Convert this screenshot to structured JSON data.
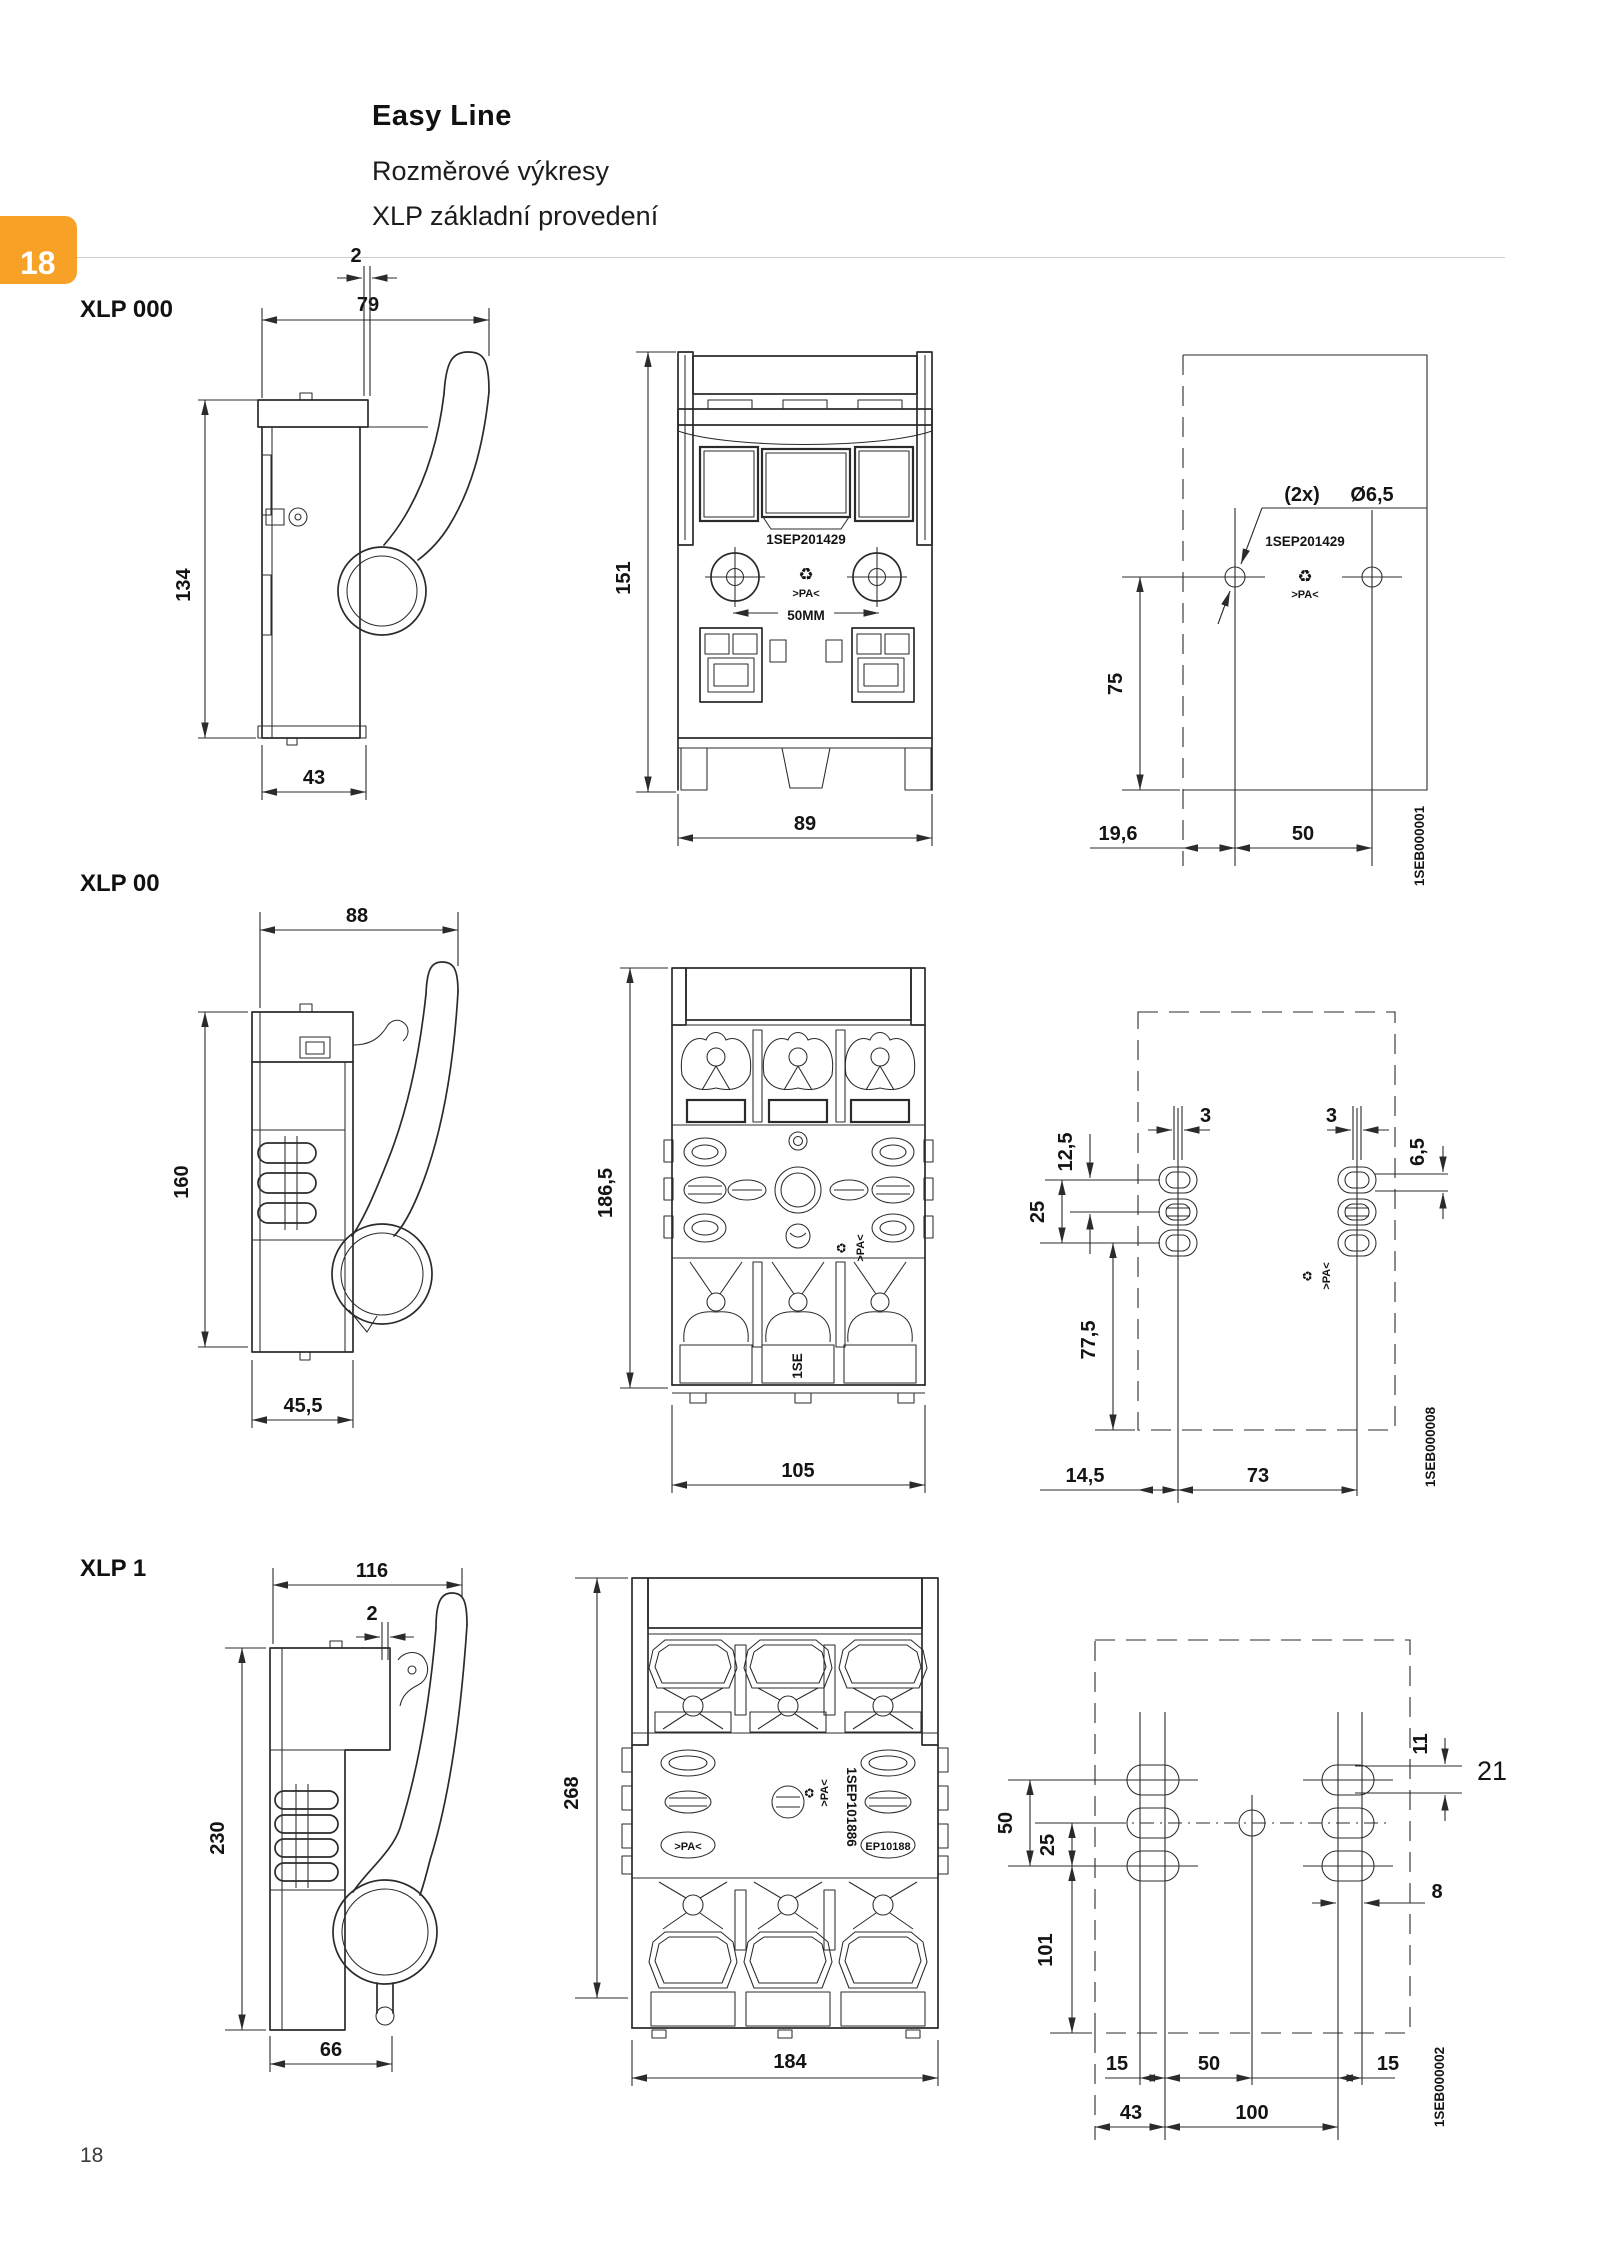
{
  "page": {
    "tab_number": "18",
    "page_number": "18",
    "accent_color": "#F7A127"
  },
  "header": {
    "title": "Easy Line",
    "subtitle_line1": "Rozměrové výkresy",
    "subtitle_line2": "XLP základní provedení"
  },
  "icons": {
    "recycling": "♻"
  },
  "sections": [
    {
      "name": "XLP 000",
      "side_view": {
        "dim_width": "79",
        "dim_gap": "2",
        "dim_height": "134",
        "dim_depth": "43"
      },
      "front_view": {
        "dim_height": "151",
        "dim_width": "89",
        "part_number": "1SEP201429",
        "material_marking": ">PA<",
        "fuse_label": "50MM"
      },
      "drill_plan": {
        "hole_count": "(2x)",
        "hole_diameter": "Ø6,5",
        "part_number": "1SEP201429",
        "material_marking": ">PA<",
        "dim_vertical": "75",
        "dim_offset": "19,6",
        "dim_spacing": "50",
        "drawing_number": "1SEB000001"
      }
    },
    {
      "name": "XLP 00",
      "side_view": {
        "dim_width": "88",
        "dim_height": "160",
        "dim_depth": "45,5"
      },
      "front_view": {
        "dim_height": "186,5",
        "dim_width": "105",
        "marking": "1SE"
      },
      "drill_plan": {
        "dim_slot_left": "3",
        "dim_slot_right": "3",
        "dim_slot_height": "6,5",
        "dim_row_gap": "12,5",
        "dim_row_span": "25",
        "dim_bottom_marg": "77,5",
        "dim_offset": "14,5",
        "dim_spacing": "73",
        "material_marking": ">PA<",
        "drawing_number": "1SEB000008"
      }
    },
    {
      "name": "XLP 1",
      "side_view": {
        "dim_width": "116",
        "dim_gap": "2",
        "dim_height": "230",
        "dim_depth": "66"
      },
      "front_view": {
        "dim_height": "268",
        "dim_width": "184",
        "part_number": "1SEP101886",
        "oval_marking": "EP10188",
        "material_marking": ">PA<"
      },
      "drill_plan": {
        "dim_row_span": "50",
        "dim_row_gap": "25",
        "dim_bottom_marg": "101",
        "dim_slot_height": "11",
        "dim_note": "21",
        "dim_slot_width": "8",
        "dim_left1": "15",
        "dim_center": "50",
        "dim_right1": "15",
        "dim_left2": "43",
        "dim_center2": "100",
        "drawing_number": "1SEB000002"
      }
    }
  ]
}
